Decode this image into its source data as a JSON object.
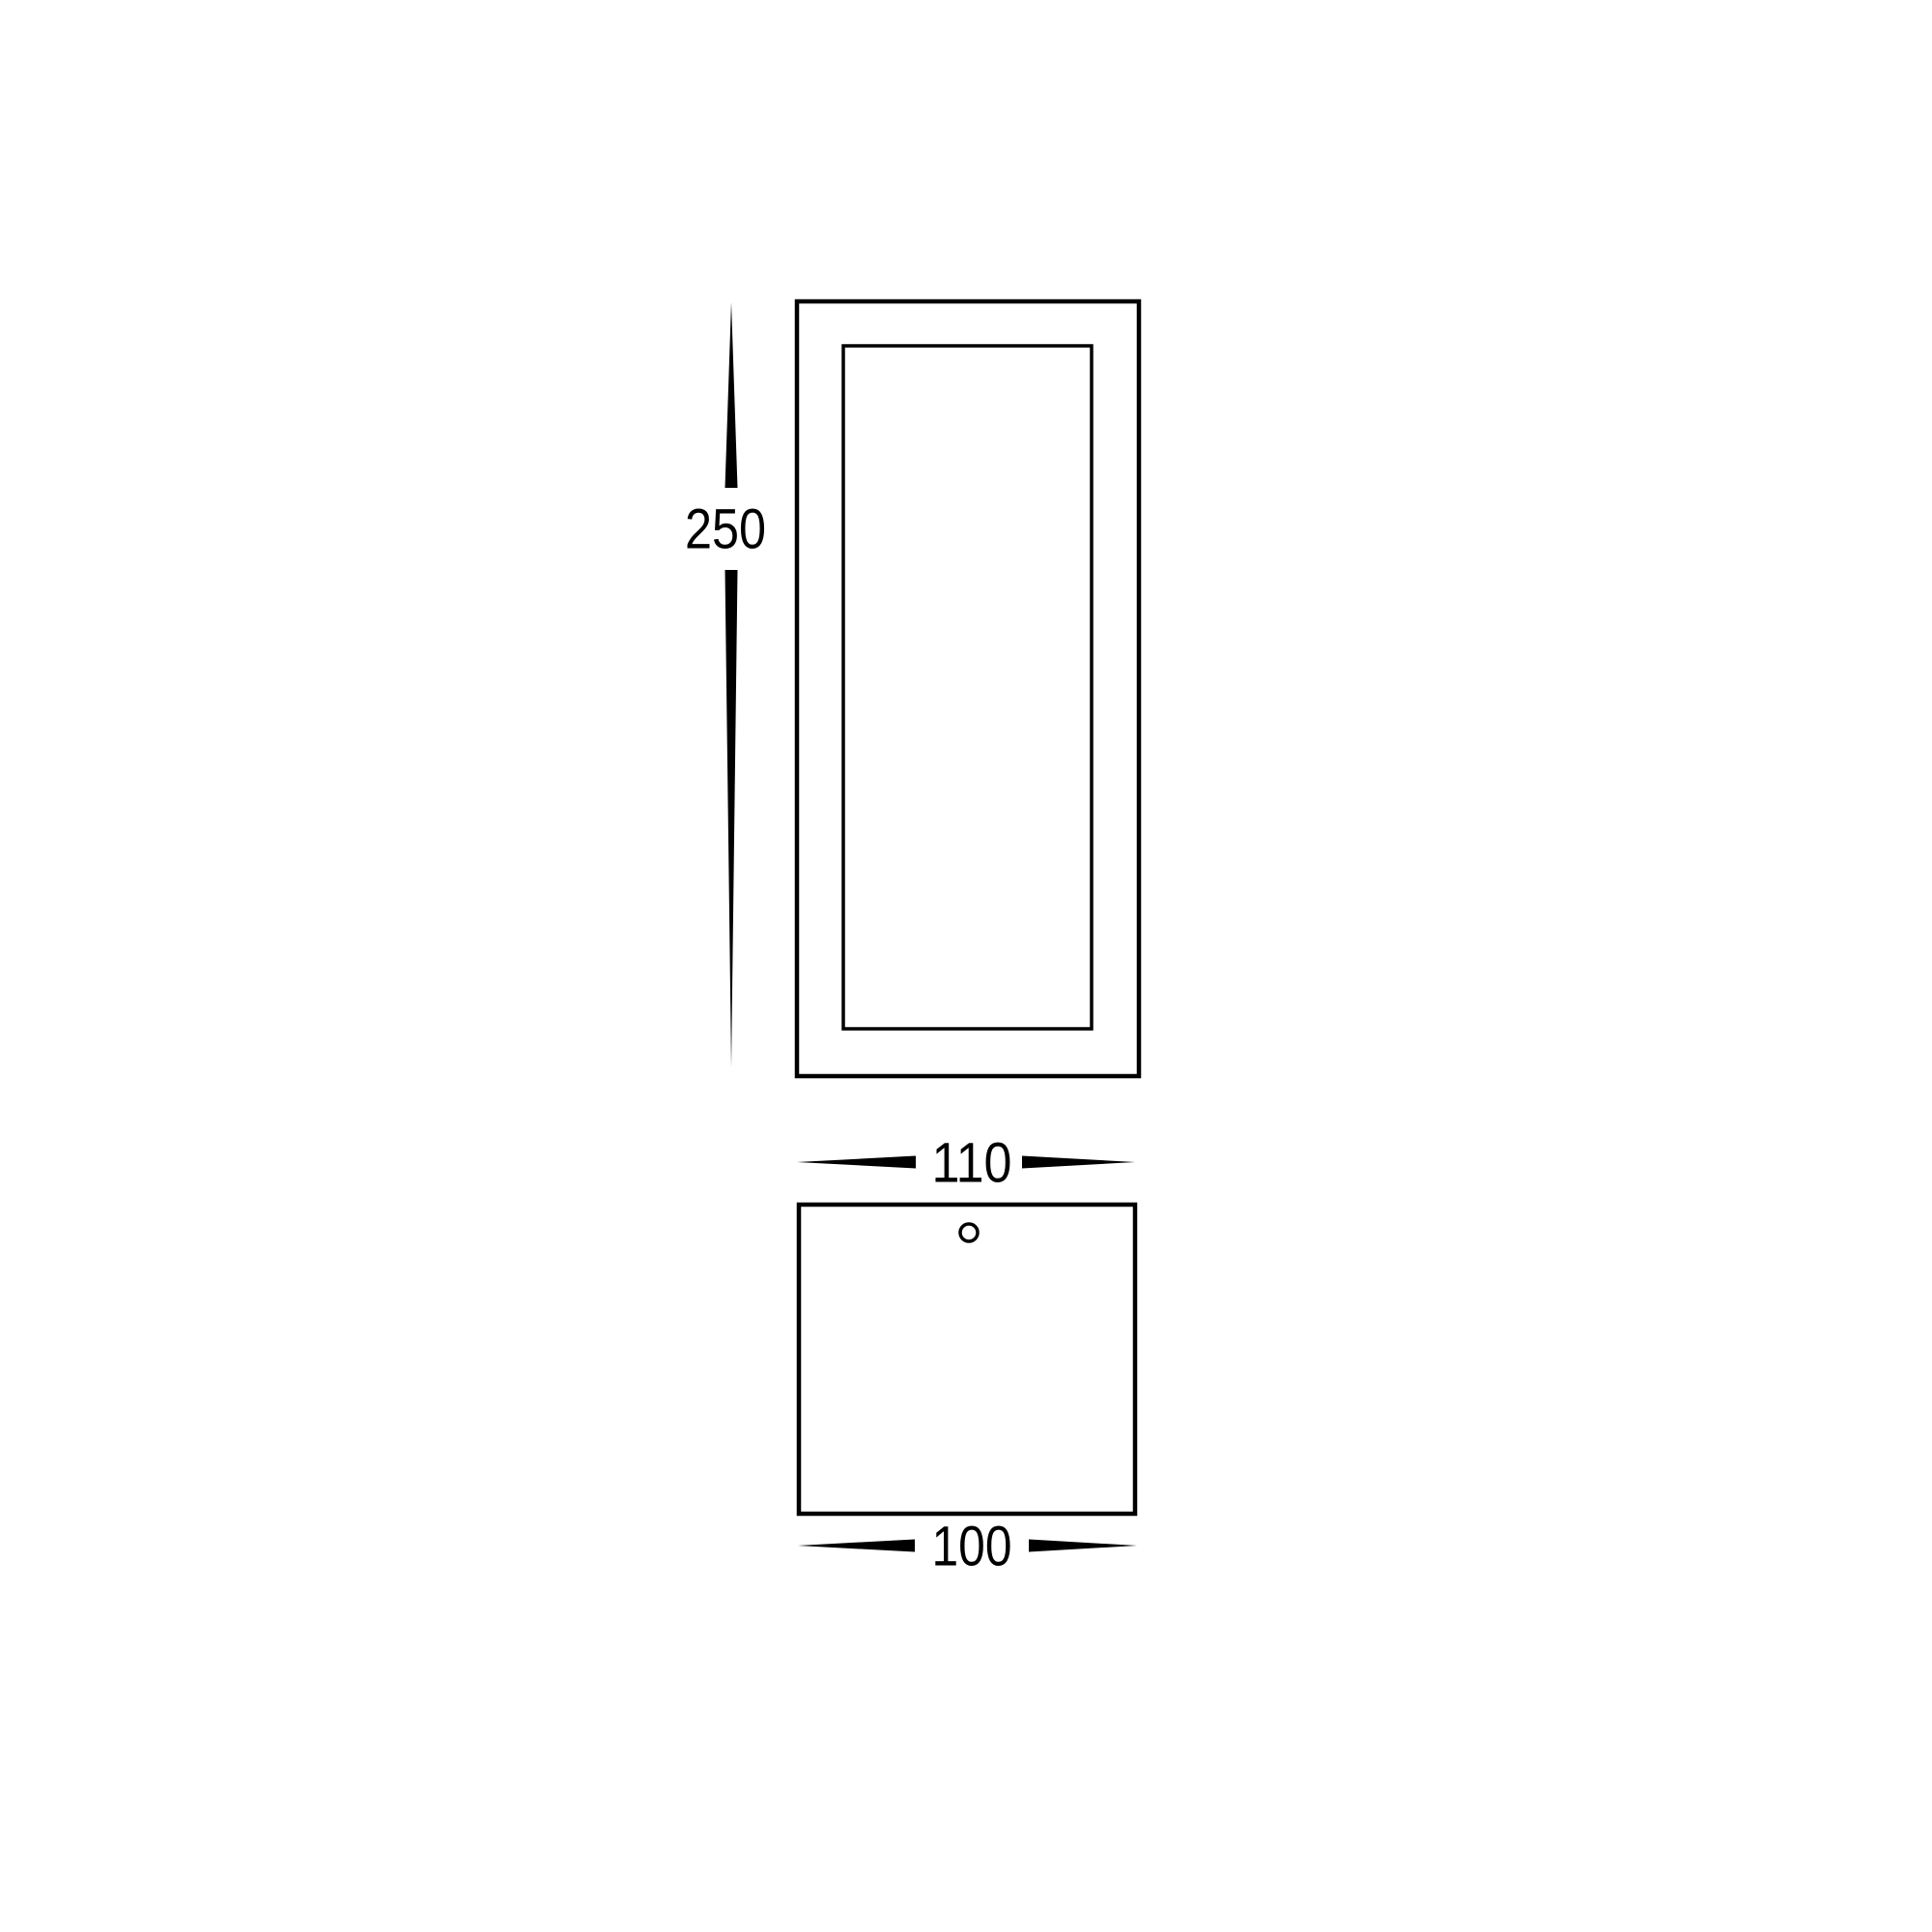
{
  "diagram": {
    "type": "technical-dimension-drawing",
    "background_color": "#ffffff",
    "stroke_color": "#000000",
    "views": [
      {
        "name": "front-view",
        "description": "rectangular outline with inset panel"
      },
      {
        "name": "top-view",
        "description": "square outline with small mounting hole circle"
      }
    ],
    "dimensions": {
      "height": {
        "label": "250",
        "orientation": "vertical"
      },
      "width": {
        "label": "110",
        "orientation": "horizontal"
      },
      "depth": {
        "label": "100",
        "orientation": "horizontal"
      }
    }
  }
}
